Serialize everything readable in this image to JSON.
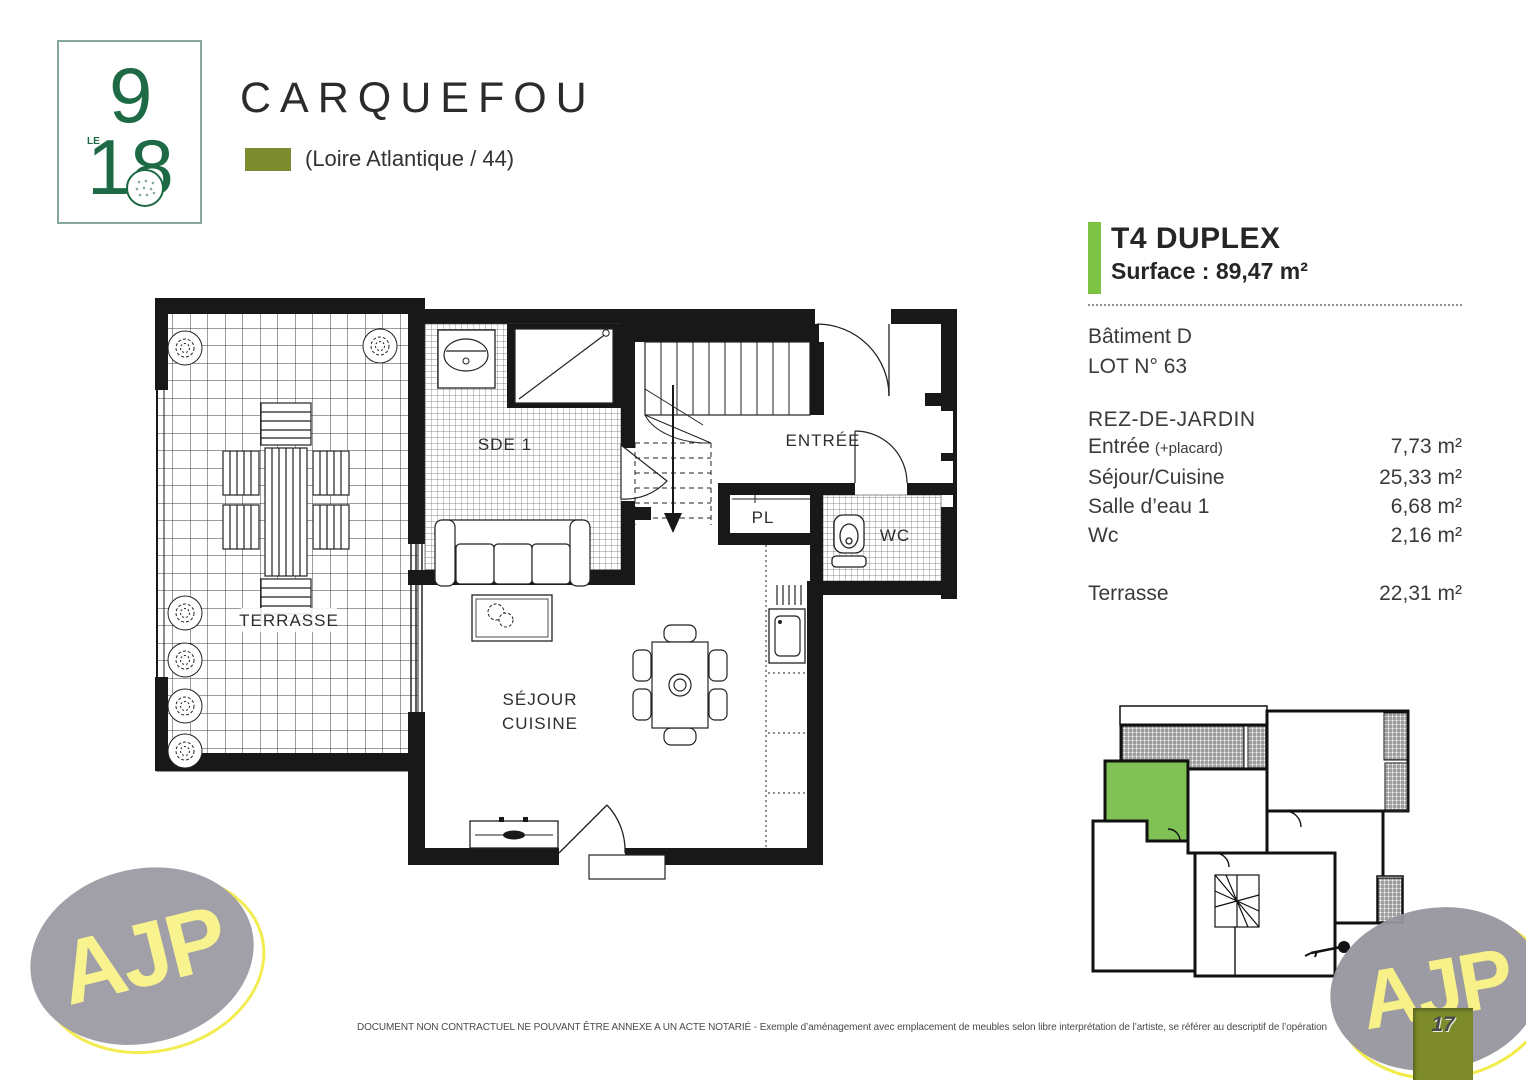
{
  "colors": {
    "accent_green": "#7dc242",
    "olive_green": "#7d8c2e",
    "logo_green": "#1d6a45",
    "logo_border": "#86a79b",
    "ajp_gray": "#97959e",
    "ajp_yellow": "#f8f183",
    "plan_ink": "#181818"
  },
  "header": {
    "logo": {
      "le": "LE",
      "nine": "9",
      "eighteen": "18"
    },
    "title": "CARQUEFOU",
    "subtitle": "(Loire Atlantique / 44)"
  },
  "unit": {
    "type": "T4 DUPLEX",
    "surface": "Surface : 89,47 m²",
    "building": "Bâtiment D",
    "lot": "LOT N° 63",
    "level": "REZ-DE-JARDIN",
    "rooms": [
      {
        "name": "Entrée",
        "note": "(+placard)",
        "area": "7,73 m²"
      },
      {
        "name": "Séjour/Cuisine",
        "note": "",
        "area": "25,33 m²"
      },
      {
        "name": "Salle d’eau 1",
        "note": "",
        "area": "6,68 m²"
      },
      {
        "name": "Wc",
        "note": "",
        "area": "2,16 m²"
      }
    ],
    "outdoor": {
      "name": "Terrasse",
      "area": "22,31 m²"
    }
  },
  "floorplan": {
    "labels": {
      "terrasse": "TERRASSE",
      "sde1": "SDE 1",
      "entree": "ENTRÉE",
      "pl": "PL",
      "wc": "WC",
      "sejour_line1": "SÉJOUR",
      "sejour_line2": "CUISINE"
    }
  },
  "footer": {
    "disclaimer": "DOCUMENT NON CONTRACTUEL NE POUVANT ÊTRE ANNEXE A UN ACTE NOTARIÉ - Exemple d’aménagement avec emplacement de meubles selon libre interprétation de l’artiste, se référer au descriptif de l’opération",
    "page": "17",
    "brand": "AJP"
  }
}
